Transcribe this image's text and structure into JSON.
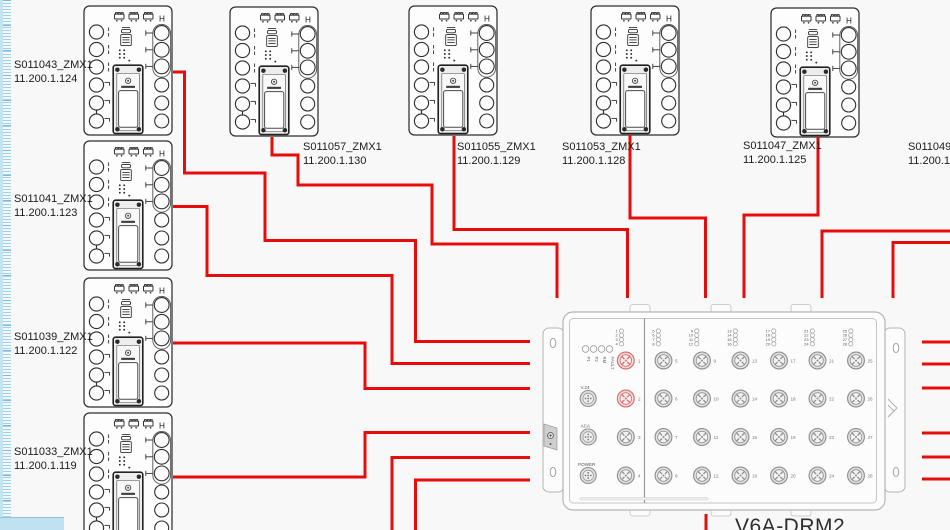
{
  "app": {
    "canvas_background": "#f8f8f8"
  },
  "colors": {
    "cable": "#e80b0b",
    "port_highlight": "#d96a6a",
    "ruler_tick": "#85bedd",
    "corner_block": "#bfe1f1"
  },
  "devices": [
    {
      "id": "zmx-043",
      "name": "S011043_ZMX1",
      "ip": "11.200.1.124"
    },
    {
      "id": "zmx-041",
      "name": "S011041_ZMX1",
      "ip": "11.200.1.123"
    },
    {
      "id": "zmx-039",
      "name": "S011039_ZMX1",
      "ip": "11.200.1.122"
    },
    {
      "id": "zmx-033",
      "name": "S011033_ZMX1",
      "ip": "11.200.1.119"
    },
    {
      "id": "zmx-057",
      "name": "S011057_ZMX1",
      "ip": "11.200.1.130"
    },
    {
      "id": "zmx-055",
      "name": "S011055_ZMX1",
      "ip": "11.200.1.129"
    },
    {
      "id": "zmx-053",
      "name": "S011053_ZMX1",
      "ip": "11.200.1.128"
    },
    {
      "id": "zmx-047",
      "name": "S011047_ZMX1",
      "ip": "11.200.1.125"
    },
    {
      "id": "zmx-049",
      "name": "S011049",
      "ip": "11.200.1"
    }
  ],
  "drm": {
    "title": "V6A-DRM2",
    "status_leds": [
      "P1",
      "P2",
      "RM",
      "FAULT"
    ],
    "led_columns": [
      [
        "1",
        "2",
        "3",
        "4"
      ],
      [
        "5",
        "6",
        "7",
        "8"
      ],
      [
        "9",
        "10",
        "11",
        "12"
      ],
      [
        "13",
        "14",
        "15",
        "16"
      ],
      [
        "17",
        "18",
        "19",
        "20"
      ],
      [
        "21",
        "22",
        "23",
        "24"
      ],
      [
        "25",
        "26",
        "27",
        "28"
      ]
    ],
    "left_ports": [
      "1",
      "2",
      "3",
      "4"
    ],
    "highlighted_ports": [
      "1",
      "2"
    ],
    "aux_connectors": [
      "V.24",
      "ACA",
      "POWER"
    ],
    "grid_ports": [
      "5",
      "6",
      "7",
      "8",
      "9",
      "10",
      "11",
      "12",
      "13",
      "14",
      "15",
      "16",
      "17",
      "18",
      "19",
      "20",
      "21",
      "22",
      "23",
      "24",
      "25",
      "26",
      "27",
      "28"
    ]
  }
}
